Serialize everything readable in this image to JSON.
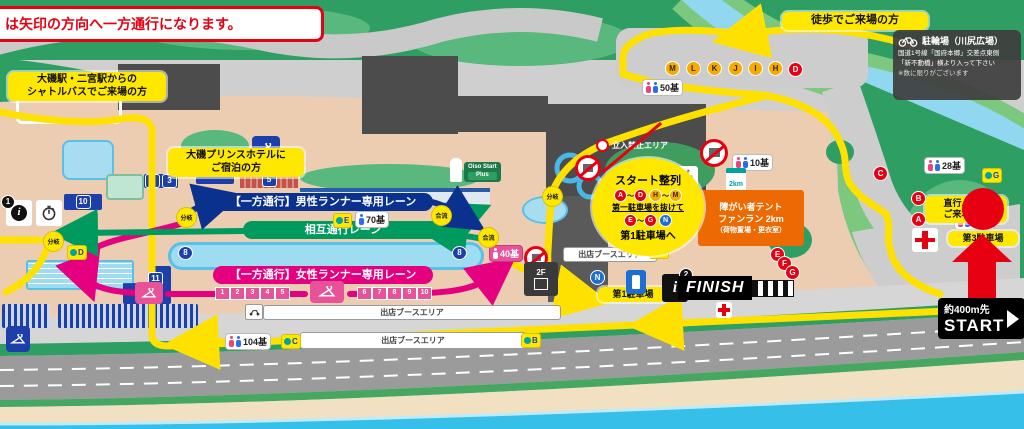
{
  "banner": {
    "one_way_notice": "は矢印の方向へ一方通行になります。"
  },
  "access_labels": {
    "shuttle_line1": "大磯駅・二宮駅からの",
    "shuttle_line2": "シャトルバスでご来場の方",
    "hotel_line1": "大磯プリンスホテルに",
    "hotel_line2": "ご宿泊の方",
    "walk": "徒歩でご来場の方",
    "direct_bus_line1": "直行バスで",
    "direct_bus_line2": "ご来場の方"
  },
  "bicycle_parking": {
    "title": "駐輪場（川尻広場）",
    "line1": "国道1号線「国府本郷」交差点東側",
    "line2": "「新不動橋」横より入って下さい",
    "line3": "※数に限りがございます"
  },
  "lanes": {
    "male": "【一方通行】男性ランナー専用レーン",
    "mutual": "相互通行レーン",
    "female": "【一方通行】女性ランナー専用レーン"
  },
  "start_lineup": {
    "title": "スタート整列",
    "tilde": "～",
    "group1_from": "A",
    "group1_to": "D",
    "group2_from": "H",
    "group2_to": "M",
    "via": "第一駐車場を抜けて",
    "group3_from": "E",
    "group3_to": "G",
    "group4": "N",
    "dest": "第1駐車場へ"
  },
  "fun_run_tent": {
    "line1": "障がい者テント",
    "line2": "ファンラン 2km",
    "line3": "（荷物置場・更衣室）",
    "sign": "2km"
  },
  "areas": {
    "no_entry": "立入禁止エリア",
    "booth": "出店ブースエリア",
    "parking1": "第1駐車場",
    "parking3": "第3駐車場",
    "floor2": "2F"
  },
  "goal": {
    "finish": "FINISH",
    "start_distance": "約400m先",
    "start": "START"
  },
  "route_words": {
    "branch": "分岐",
    "merge": "合流"
  },
  "toilets": {
    "t50": "50基",
    "t70": "70基",
    "t10": "10基",
    "t40": "40基",
    "t40f": "40基",
    "t104": "104基",
    "t28": "28基",
    "t32": "32基"
  },
  "markers": {
    "walk_letters": [
      "M",
      "L",
      "K",
      "J",
      "I",
      "H"
    ],
    "red_letters": {
      "d": "D",
      "c": "C",
      "b": "B",
      "a": "A",
      "e": "E",
      "f": "F",
      "g": "G"
    },
    "blue_letter_n": "N",
    "stations": {
      "a": "A",
      "b": "B",
      "c": "C",
      "d": "D",
      "e": "E",
      "g": "G"
    },
    "info1": "1",
    "info2": "2",
    "info_i": "i"
  },
  "buildings": {
    "n2": "2",
    "n3": "3",
    "n4": "4",
    "n5": "5",
    "n6": "6",
    "n7": "7",
    "n8": "8",
    "n10": "10",
    "n11": "11"
  },
  "changing_tiles": [
    "1",
    "2",
    "3",
    "4",
    "5",
    "6",
    "7",
    "8",
    "9",
    "10"
  ],
  "signs": {
    "oiso_line1": "Oiso Start",
    "oiso_line2": "Plus"
  },
  "colors": {
    "route": "#ffe100",
    "male_lane": "#0b318f",
    "mutual_lane": "#009a5e",
    "female_lane": "#e4007f",
    "marker_red": "#e60012"
  }
}
